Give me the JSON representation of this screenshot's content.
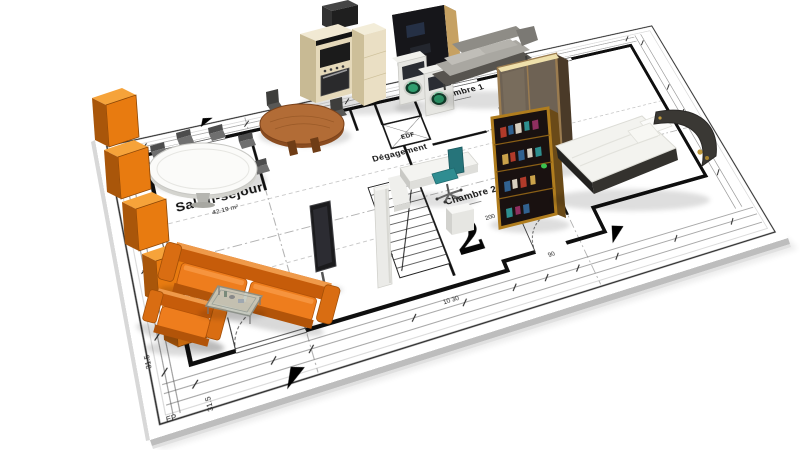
{
  "scene": {
    "description": "3D isometric render of an architectural floor plan sheet with furniture",
    "background": "#ffffff"
  },
  "rooms": [
    {
      "id": "salon",
      "label": "Salon-séjour",
      "area": "42.19 m²"
    },
    {
      "id": "cuisine",
      "label": "Cuisine"
    },
    {
      "id": "degagement",
      "label": "Dégagement"
    },
    {
      "id": "chambre1",
      "label": "Chambre 1"
    },
    {
      "id": "chambre2",
      "label": "Chambre 2"
    },
    {
      "id": "edf",
      "label": "EDF"
    }
  ],
  "annotations": {
    "zone_number": "2",
    "ep_label": "EP",
    "dimensions": {
      "d37": "37",
      "d165": "16.5",
      "d200": "200",
      "d201": "201",
      "d90": "90",
      "d1030": "10 30",
      "d315a": "31.5",
      "d315b": "31.5"
    }
  },
  "furniture": [
    "orange-shelf-unit",
    "dining-table-oval",
    "dining-chairs",
    "kitchen-round-table",
    "kitchen-chairs",
    "kitchen-cabinets",
    "range-hood",
    "tall-dark-cabinet",
    "washer-dryer-pair",
    "gray-daybed",
    "sliding-door-wardrobe",
    "bookshelf",
    "double-bed",
    "office-desk",
    "office-chair-teal",
    "nightstand-cube",
    "tv-on-stand",
    "white-column",
    "orange-sofa",
    "orange-armchair",
    "coffee-table"
  ],
  "colors": {
    "sofa_orange": "#ee7d1d",
    "shelf_orange": "#e8750c",
    "wood_table": "#b26c36",
    "wardrobe_bronze": "#9b7c50",
    "office_chair_teal": "#2f8d91",
    "washer_door_green": "#2f9e6e",
    "paper_white": "#ffffff",
    "ink": "#111111"
  }
}
